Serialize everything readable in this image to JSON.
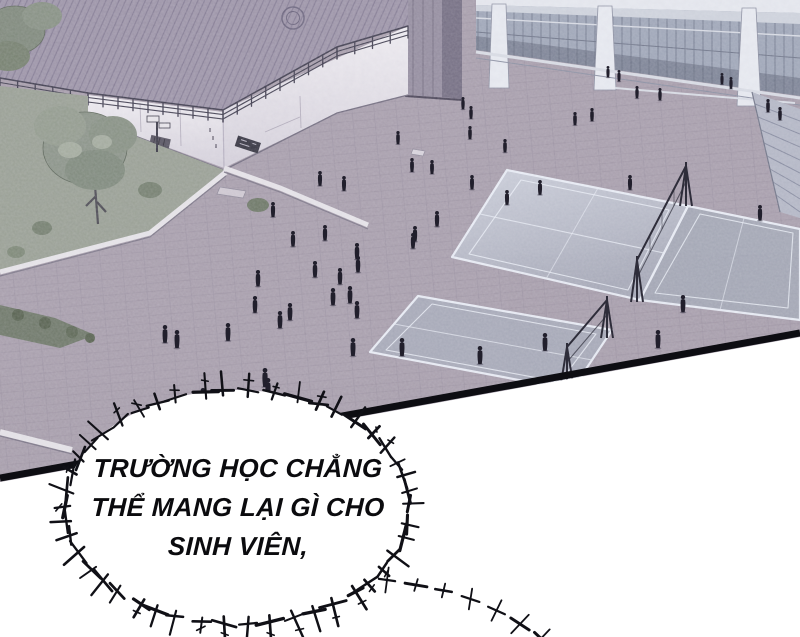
{
  "speech_bubble": {
    "lines": [
      "TRƯỜNG HỌC CHẲNG",
      "THỂ MANG LẠI GÌ CHO",
      "SINH VIÊN,"
    ]
  },
  "colors": {
    "plaza": "#a89fac",
    "roof": "#9d95a8",
    "wall_white": "#ebe9ed",
    "grass": "#99a094",
    "court": "#a6abb9",
    "court_line": "#e9edf5",
    "glass": "#9fa7b8",
    "pillar": "#948d9f",
    "figure": "#211f2c",
    "panel_border": "#0d0d12",
    "bubble_fill": "#ffffff",
    "spike": "#101016"
  },
  "scene": {
    "figures": [
      {
        "x": 575,
        "y": 112,
        "s": 0.8
      },
      {
        "x": 592,
        "y": 108,
        "s": 0.8
      },
      {
        "x": 608,
        "y": 66,
        "s": 0.7
      },
      {
        "x": 619,
        "y": 70,
        "s": 0.7
      },
      {
        "x": 637,
        "y": 86,
        "s": 0.75
      },
      {
        "x": 660,
        "y": 88,
        "s": 0.75
      },
      {
        "x": 722,
        "y": 73,
        "s": 0.7
      },
      {
        "x": 731,
        "y": 77,
        "s": 0.72
      },
      {
        "x": 768,
        "y": 99,
        "s": 0.8
      },
      {
        "x": 780,
        "y": 107,
        "s": 0.8
      },
      {
        "x": 463,
        "y": 97,
        "s": 0.75
      },
      {
        "x": 471,
        "y": 106,
        "s": 0.78
      },
      {
        "x": 398,
        "y": 131,
        "s": 0.8
      },
      {
        "x": 470,
        "y": 126,
        "s": 0.8
      },
      {
        "x": 505,
        "y": 139,
        "s": 0.82
      },
      {
        "x": 412,
        "y": 158,
        "s": 0.85
      },
      {
        "x": 432,
        "y": 160,
        "s": 0.85
      },
      {
        "x": 472,
        "y": 175,
        "s": 0.88
      },
      {
        "x": 540,
        "y": 180,
        "s": 0.9
      },
      {
        "x": 507,
        "y": 190,
        "s": 0.9
      },
      {
        "x": 630,
        "y": 175,
        "s": 0.9
      },
      {
        "x": 760,
        "y": 205,
        "s": 0.95
      },
      {
        "x": 320,
        "y": 171,
        "s": 0.9
      },
      {
        "x": 344,
        "y": 176,
        "s": 0.9
      },
      {
        "x": 273,
        "y": 202,
        "s": 0.92
      },
      {
        "x": 293,
        "y": 231,
        "s": 0.95
      },
      {
        "x": 325,
        "y": 225,
        "s": 0.95
      },
      {
        "x": 415,
        "y": 226,
        "s": 0.95
      },
      {
        "x": 437,
        "y": 211,
        "s": 0.95
      },
      {
        "x": 413,
        "y": 233,
        "s": 0.95
      },
      {
        "x": 357,
        "y": 243,
        "s": 1.0
      },
      {
        "x": 358,
        "y": 256,
        "s": 1.0
      },
      {
        "x": 340,
        "y": 268,
        "s": 1.0
      },
      {
        "x": 315,
        "y": 261,
        "s": 1.0
      },
      {
        "x": 258,
        "y": 270,
        "s": 1.0
      },
      {
        "x": 255,
        "y": 296,
        "s": 1.02
      },
      {
        "x": 290,
        "y": 303,
        "s": 1.05
      },
      {
        "x": 280,
        "y": 311,
        "s": 1.05
      },
      {
        "x": 333,
        "y": 288,
        "s": 1.05
      },
      {
        "x": 350,
        "y": 286,
        "s": 1.05
      },
      {
        "x": 357,
        "y": 301,
        "s": 1.05
      },
      {
        "x": 228,
        "y": 323,
        "s": 1.08
      },
      {
        "x": 165,
        "y": 325,
        "s": 1.08
      },
      {
        "x": 177,
        "y": 330,
        "s": 1.1
      },
      {
        "x": 353,
        "y": 338,
        "s": 1.1
      },
      {
        "x": 402,
        "y": 338,
        "s": 1.1
      },
      {
        "x": 480,
        "y": 346,
        "s": 1.1
      },
      {
        "x": 545,
        "y": 333,
        "s": 1.08
      },
      {
        "x": 658,
        "y": 330,
        "s": 1.1
      },
      {
        "x": 683,
        "y": 295,
        "s": 1.05
      },
      {
        "x": 265,
        "y": 368,
        "s": 1.15
      },
      {
        "x": 268,
        "y": 378,
        "s": 1.15
      },
      {
        "x": 203,
        "y": 388,
        "s": 1.15
      }
    ]
  }
}
